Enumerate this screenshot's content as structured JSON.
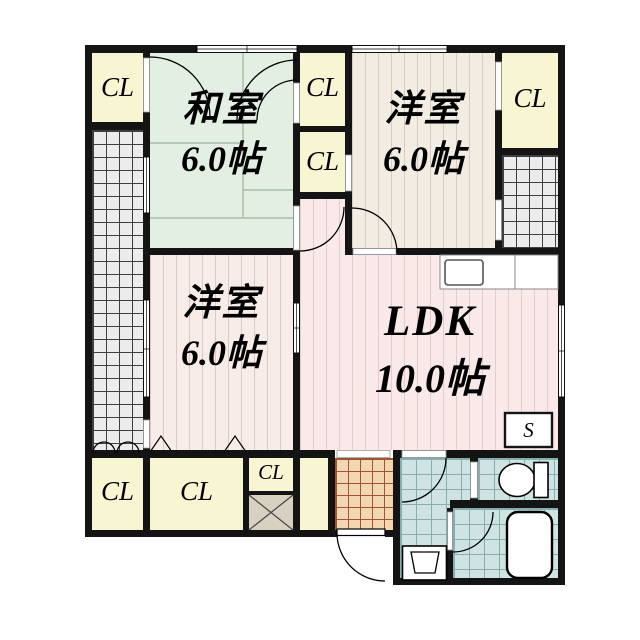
{
  "floorplan": {
    "type": "japanese-apartment-floor-plan",
    "rooms": {
      "washitsu": {
        "name": "和室",
        "size": "6.0帖"
      },
      "western_top": {
        "name": "洋室",
        "size": "6.0帖"
      },
      "western_left": {
        "name": "洋室",
        "size": "6.0帖"
      },
      "ldk": {
        "name": "LDK",
        "size": "10.0帖"
      }
    },
    "closet_label": "CL",
    "closet_count": 7,
    "storage_label": "S",
    "colors": {
      "wall": "#141414",
      "closet_fill": "#f8f5d2",
      "tatami_fill": "#e3efe3",
      "western_top_fill": "#f2ece2",
      "western_left_fill": "#f7ece7",
      "ldk_fill": "#f9e9e8",
      "balcony_fill": "#ececec",
      "genkan_fill": "#f3d7b3",
      "wet_area_fill": "#cfe3e2",
      "shaft_fill": "#d8d1c2"
    },
    "icons": {
      "toilet": "toilet-icon",
      "bathtub": "bathtub-icon",
      "washbasin": "washbasin-icon",
      "kitchen_sink": "kitchen-sink-icon",
      "entry_door": "entry-door-arc-icon",
      "shaft": "x-shaft-icon",
      "folding_door": "folding-door-mark-icon"
    }
  }
}
